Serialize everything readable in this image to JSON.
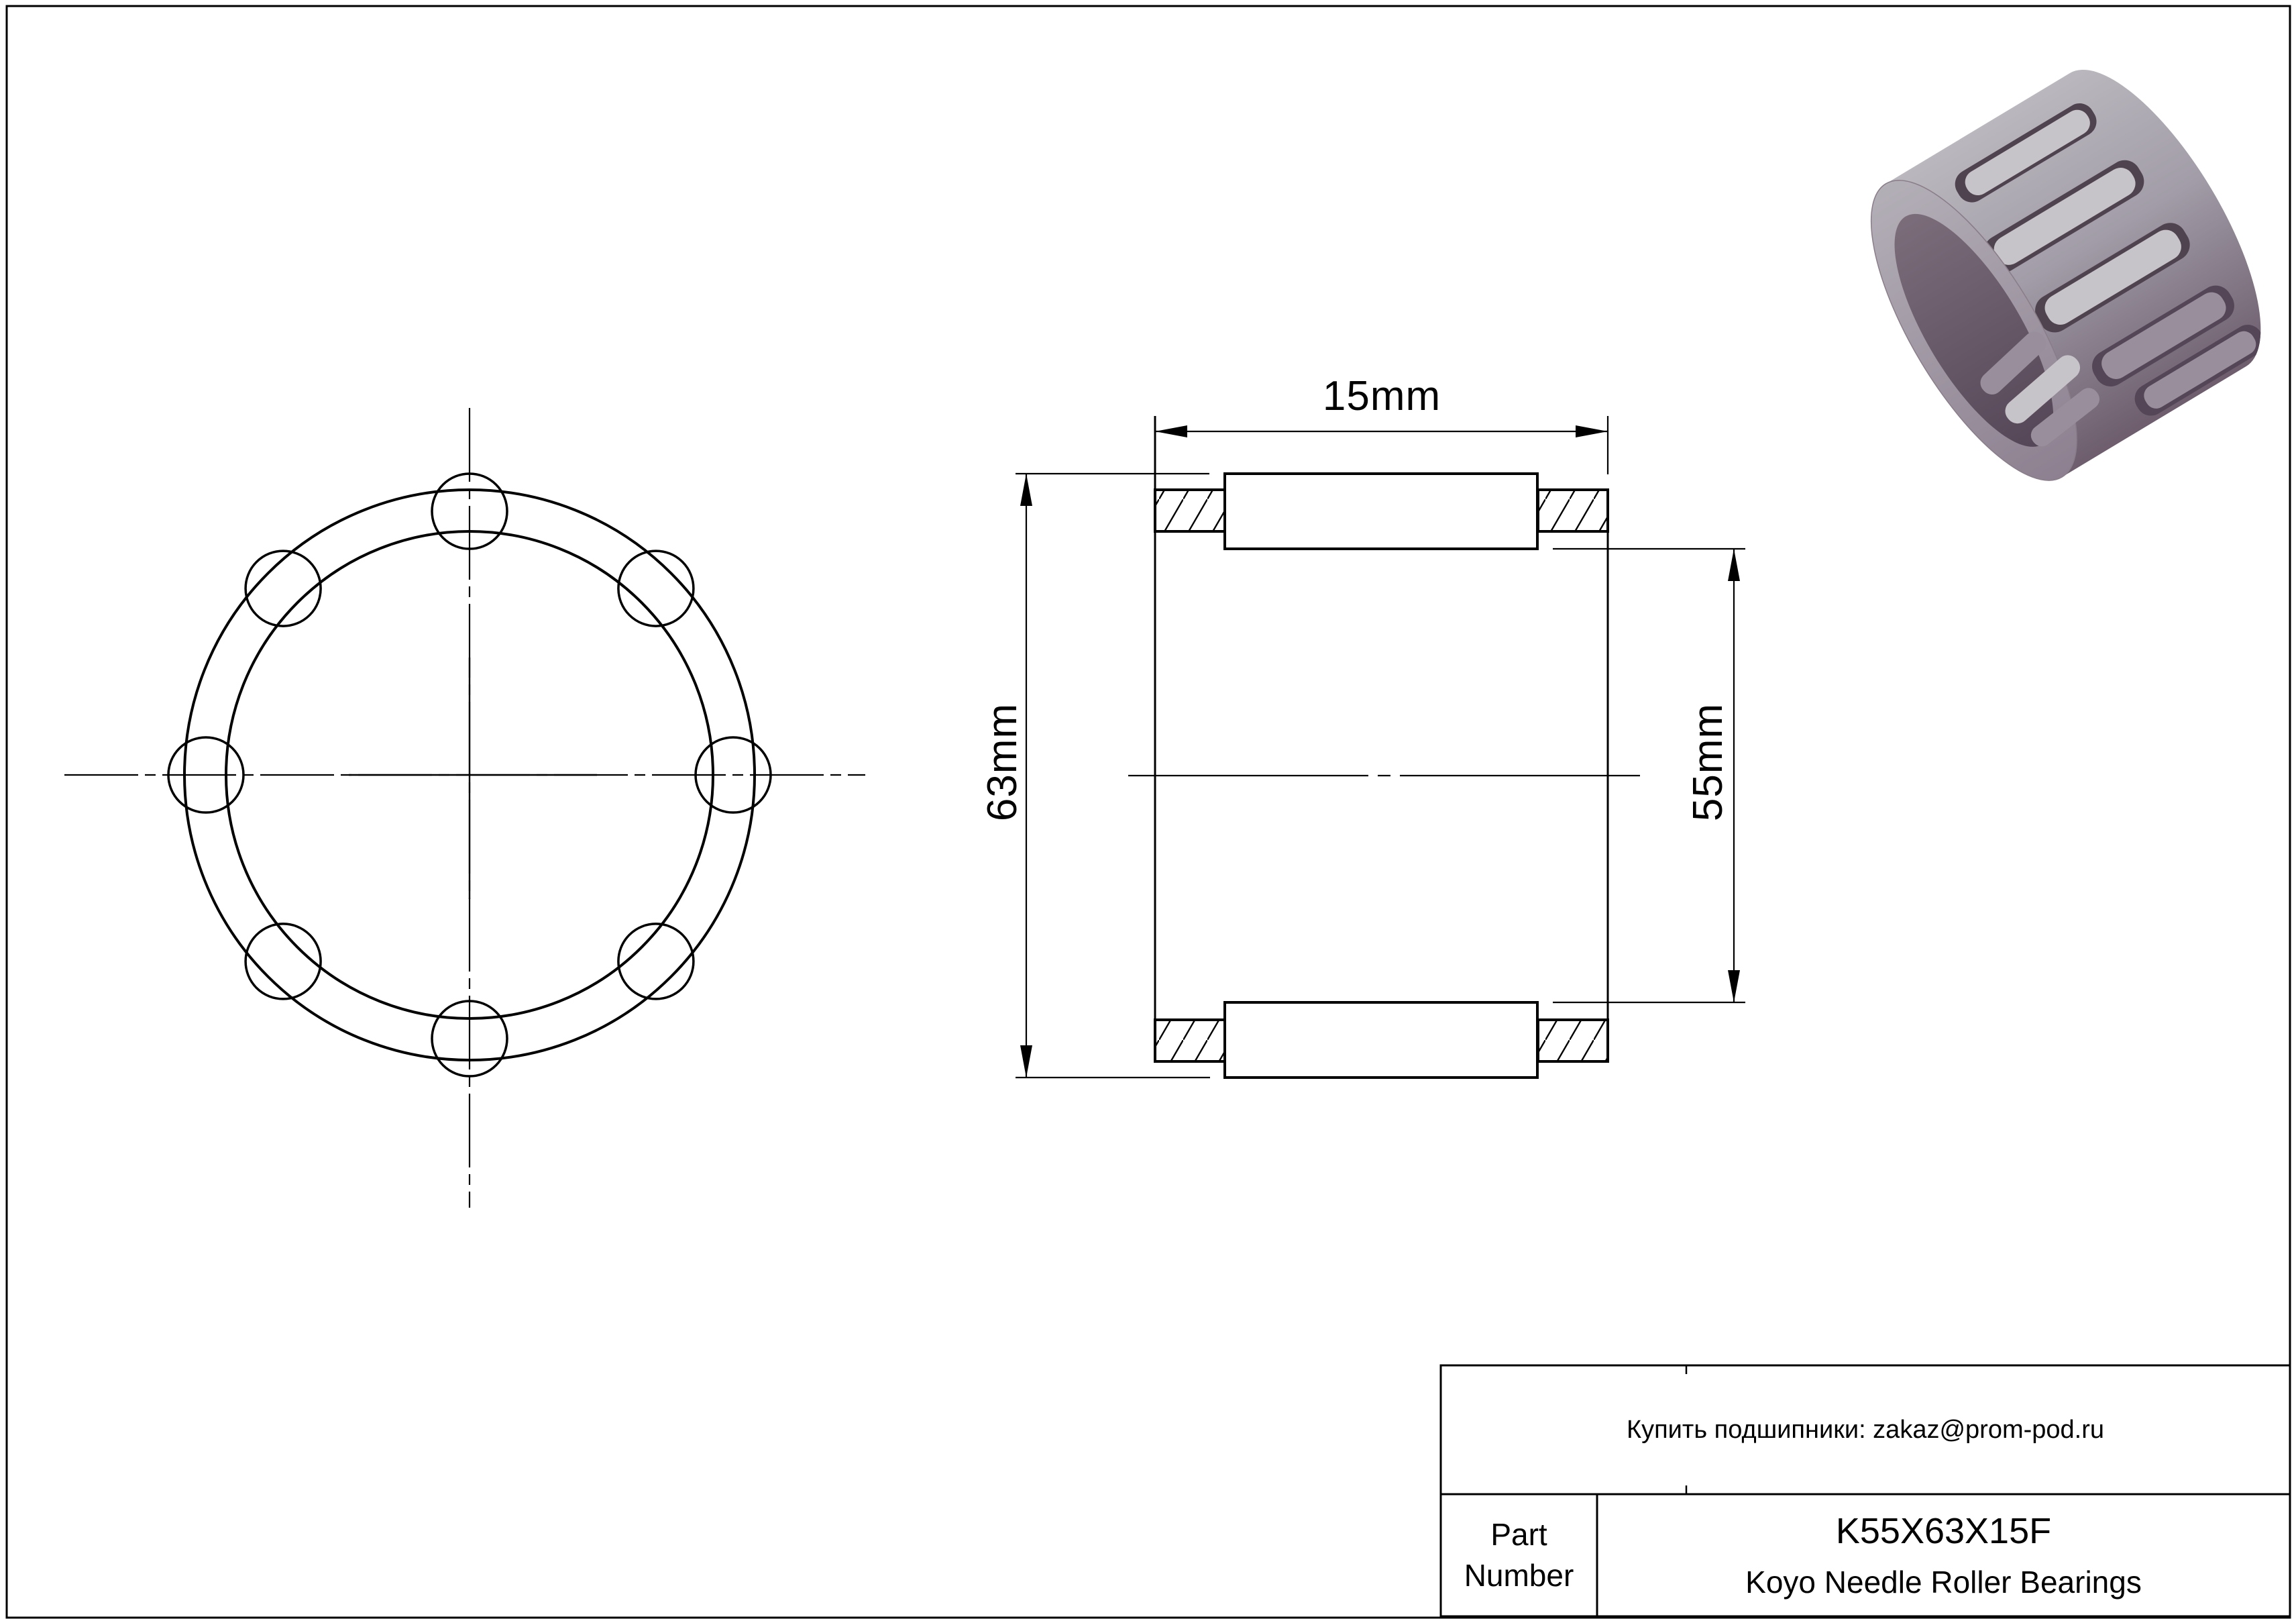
{
  "dimensions": {
    "width": "15mm",
    "outer_diameter": "63mm",
    "bore_diameter": "55mm"
  },
  "title_block": {
    "contact": "Купить подшипники: zakaz@prom-pod.ru",
    "part_number_label": "Part Number",
    "part_number": "K55X63X15F",
    "product_line": "Koyo Needle Roller Bearings"
  },
  "render_colors": {
    "body_light": "#bab7be",
    "body_mid": "#a29da8",
    "body_dark": "#6d5d6d",
    "rim_light": "#b3afb7",
    "rim_dark": "#8d8090",
    "bore_light": "#7c6d7b",
    "bore_dark": "#544656",
    "slot_dark": "#4f4350",
    "roller_light": "#c6c3c9",
    "roller_shaded": "#998e9b"
  }
}
